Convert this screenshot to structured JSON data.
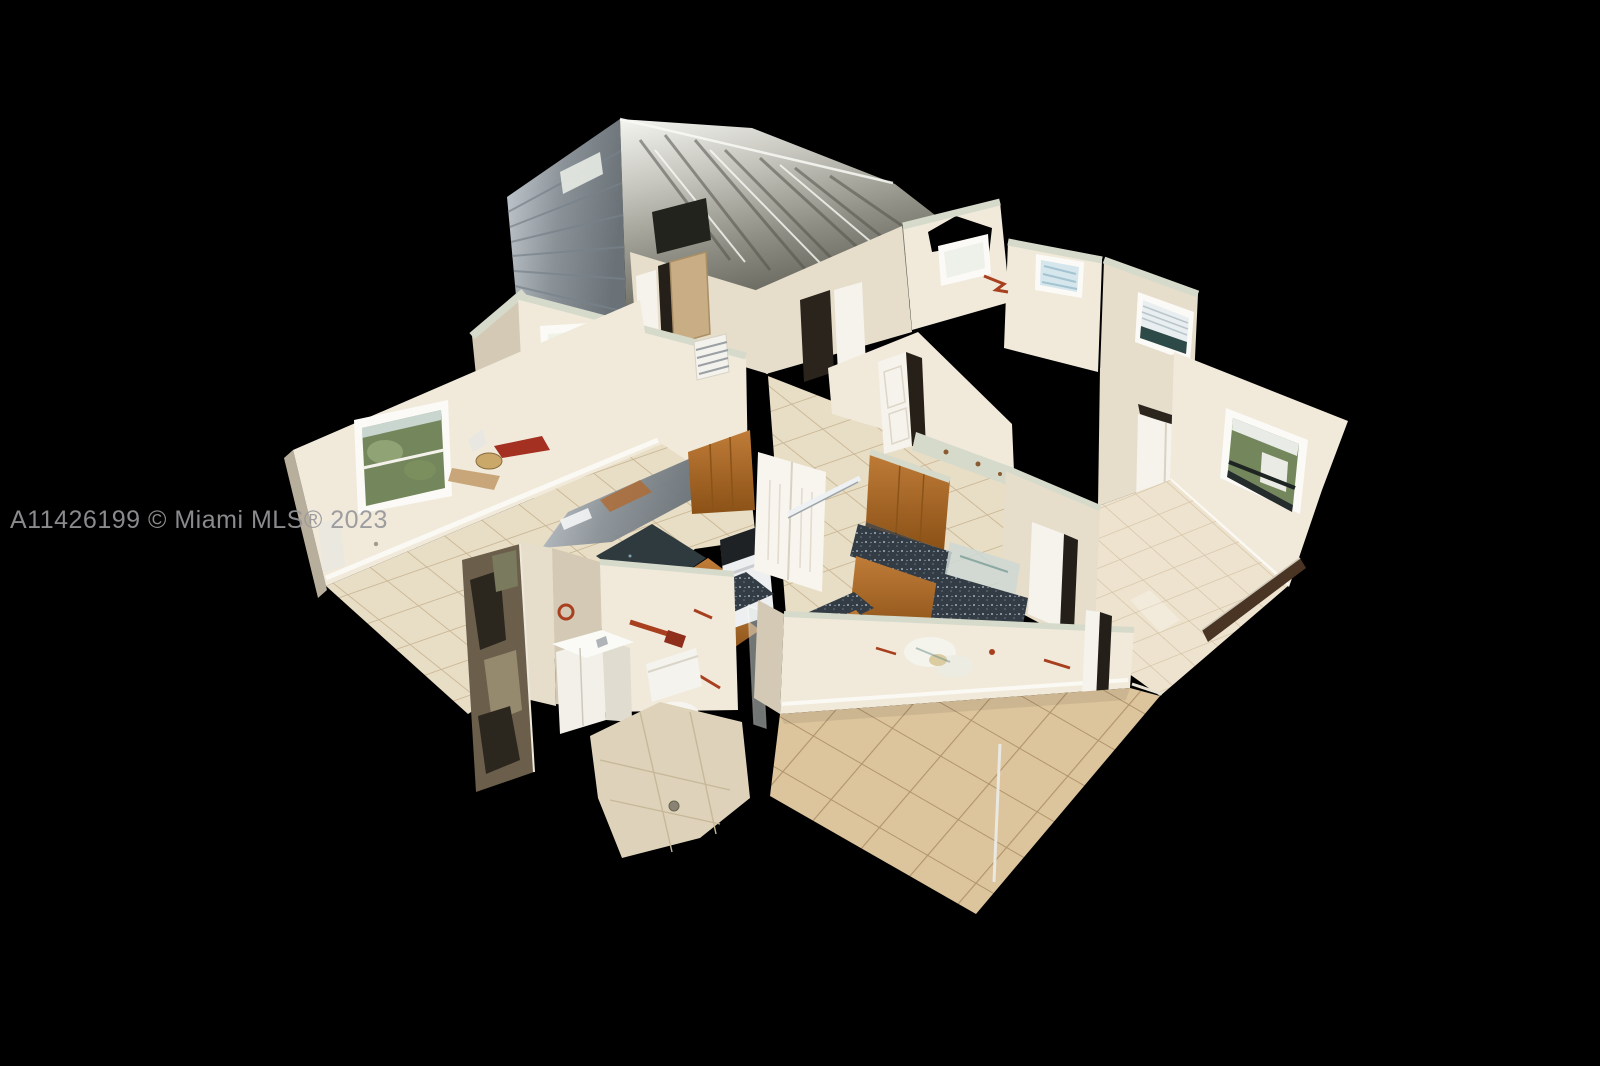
{
  "meta": {
    "type": "real-estate-3d-dollhouse-photo",
    "description": "Overhead 3D dollhouse scan of a single-story home interior (living room, dining area, kitchen, bathroom, bedrooms, family room) with an unscanned metallic garage-roof mesh, shown on a black background",
    "rooms": [
      "garage-mesh",
      "dining-area",
      "foyer",
      "living-room",
      "kitchen",
      "hallway",
      "bathroom",
      "bedroom-1",
      "bedroom-2",
      "master-bedroom",
      "family-room"
    ]
  },
  "watermark": {
    "text": "A11426199 © Miami MLS® 2023",
    "color": "#96969a"
  },
  "palette": {
    "bg": "#000000",
    "wall_light": "#f1eadb",
    "wall_mid": "#e6ddcb",
    "wall_dark": "#d3c9b4",
    "wall_edge": "#b7ae9c",
    "cut_top": "#d6dacb",
    "baseboard": "#fbf9f3",
    "tile_light": "#e8ddc5",
    "tile_grout": "#c9b795",
    "tile_warm": "#dcc49c",
    "tile_warm_grout": "#b1946c",
    "tile_pale": "#eee3cf",
    "tile_pale_grout": "#d4c3a6",
    "metal_hi": "#f2f2ee",
    "metal_dark": "#54544c",
    "wood": "#b5722f",
    "wood_dark": "#8a5318",
    "granite": "#333c44",
    "granite_fleck": "#9fb0bd",
    "glass_green": "#74875c",
    "glass_sky": "#dfe8ec",
    "blind_blue": "#d5e6ec",
    "fixture": "#f6f3ec",
    "rust": "#a8401f",
    "track": "#4a3524",
    "watermark": "#96969a"
  }
}
